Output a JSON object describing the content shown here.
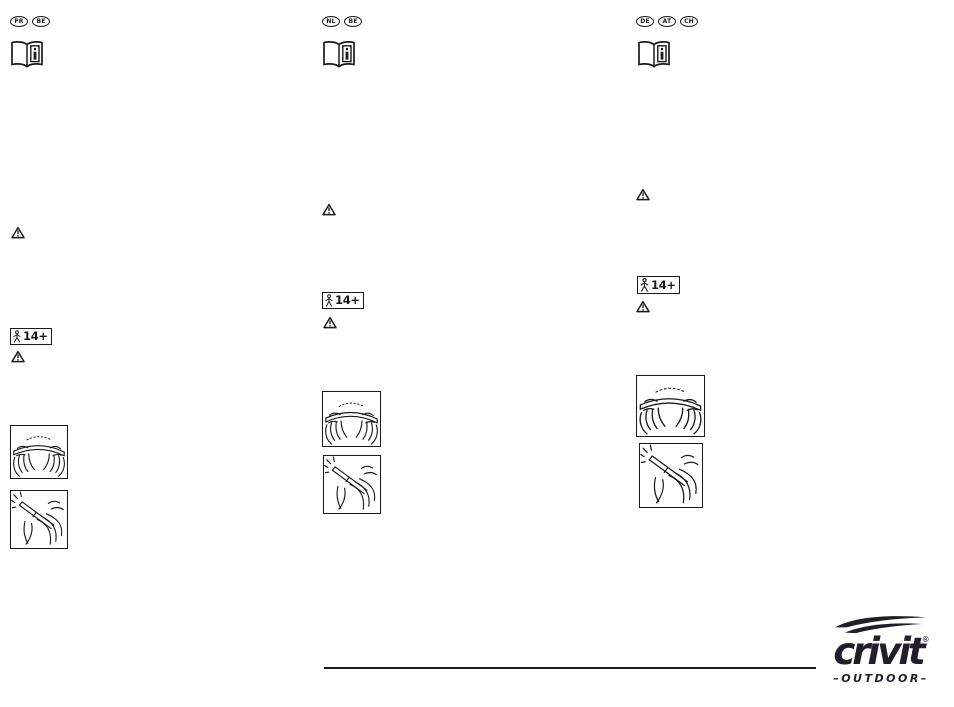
{
  "page": {
    "background": "#ffffff",
    "ink_color": "#1a1a1a"
  },
  "columns": [
    {
      "id": "col-fr-be",
      "language_badges": [
        "FR",
        "BE"
      ]
    },
    {
      "id": "col-nl-be",
      "language_badges": [
        "NL",
        "BE"
      ]
    },
    {
      "id": "col-de-at-ch",
      "language_badges": [
        "DE",
        "AT",
        "CH"
      ]
    }
  ],
  "age_rating": {
    "label": "14+"
  },
  "icons": {
    "manual": "read-instruction-manual-icon",
    "warning": "warning-triangle-icon",
    "age": "age-14-plus-icon",
    "flex": "hands-flexing-pole-illustration",
    "click": "hands-connecting-pole-illustration"
  },
  "logo": {
    "brand": "crivit",
    "registered_mark": "®",
    "tagline": "–OUTDOOR–",
    "color": "#211d29"
  }
}
